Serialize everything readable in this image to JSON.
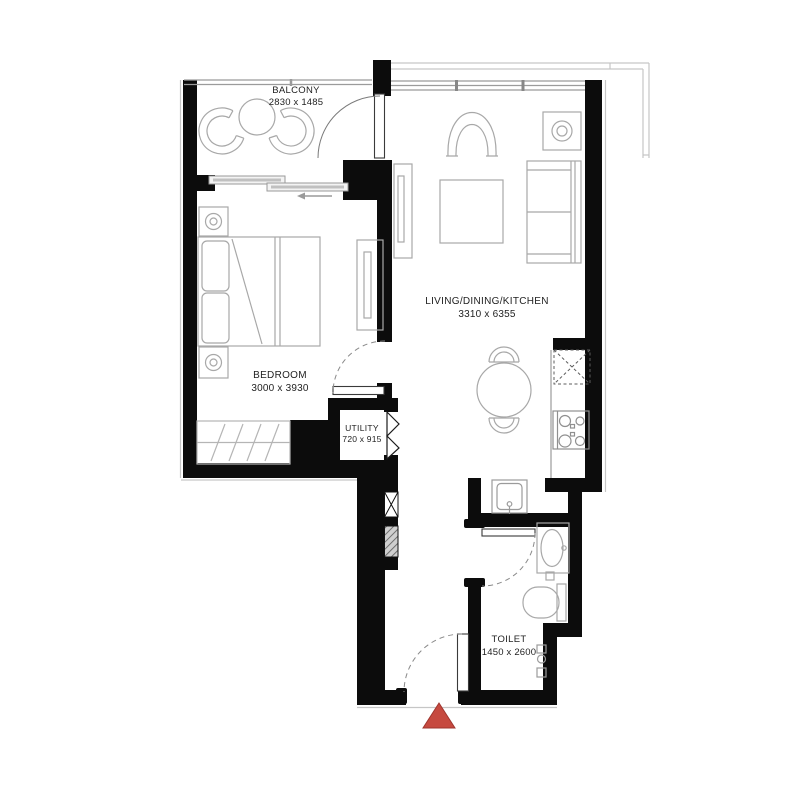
{
  "rooms": {
    "balcony": {
      "name": "BALCONY",
      "dims": "2830 x 1485"
    },
    "living": {
      "name": "LIVING/DINING/KITCHEN",
      "dims": "3310 x 6355"
    },
    "bedroom": {
      "name": "BEDROOM",
      "dims": "3000 x 3930"
    },
    "utility": {
      "name": "UTILITY",
      "dims": "720 x 915"
    },
    "toilet": {
      "name": "TOILET",
      "dims": "1450 x 2600"
    }
  },
  "colors": {
    "wall": "#0c0c0c",
    "furniture_line": "#a8a8a8",
    "window_line": "#9b9b9b",
    "entrance_marker": "#c6493f",
    "entrance_marker_border": "#9f352e"
  },
  "furniture_symbols": [
    "balcony-lounge-chair",
    "balcony-round-table",
    "sliding-door",
    "double-bed",
    "nightstand-lamp",
    "wardrobe",
    "built-in-closet",
    "tv-unit",
    "armchair",
    "coffee-table",
    "sofa",
    "side-table-lamp",
    "round-dining-table",
    "dining-chair",
    "refrigerator-space",
    "stove",
    "kitchen-sink",
    "washbasin",
    "wc",
    "bifold-door",
    "door-swing-arc",
    "entrance-marker",
    "service-shaft"
  ]
}
